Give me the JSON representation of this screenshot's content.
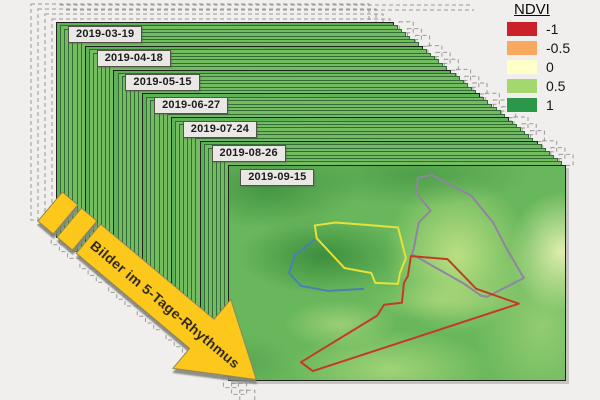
{
  "figure": {
    "background_color": "#f0efed"
  },
  "legend": {
    "title": "NDVI",
    "items": [
      {
        "value": "-1",
        "color": "#cb2128"
      },
      {
        "value": "-0.5",
        "color": "#f8a960"
      },
      {
        "value": "0",
        "color": "#ffffc8"
      },
      {
        "value": "0.5",
        "color": "#a4d86e"
      },
      {
        "value": "1",
        "color": "#2b9748"
      }
    ]
  },
  "stack": {
    "dates": [
      "2019-03-19",
      "2019-04-18",
      "2019-05-15",
      "2019-06-27",
      "2019-07-24",
      "2019-08-26",
      "2019-09-15"
    ]
  },
  "arrow": {
    "label": "Bilder im 5-Tage-Rhythmus",
    "fill": "#fcc81f"
  },
  "map": {
    "fields": [
      {
        "name": "field-outline-yellow",
        "type": "polygon",
        "color": "#e6e23a",
        "points": "82,60 103,57 166,62 174,93 168,108 166,119 143,118 139,108 112,103 84,73"
      },
      {
        "name": "field-outline-blue",
        "type": "polyline",
        "color": "#4a7fb5",
        "points": "81,75 62,90 56,108 68,121 95,126 131,124"
      },
      {
        "name": "field-outline-purple",
        "type": "polygon",
        "color": "#8f85a0",
        "points": "200,9 186,12 184,27 199,45 187,57 182,83 180,89 233,119 250,131 256,132 293,113 276,84 262,57 240,30"
      },
      {
        "name": "field-outline-red",
        "type": "polygon",
        "color": "#c33b27",
        "points": "179,91 216,94 245,124 288,139 80,207 68,198 145,151 152,140 170,138 172,118 176,111"
      }
    ]
  }
}
